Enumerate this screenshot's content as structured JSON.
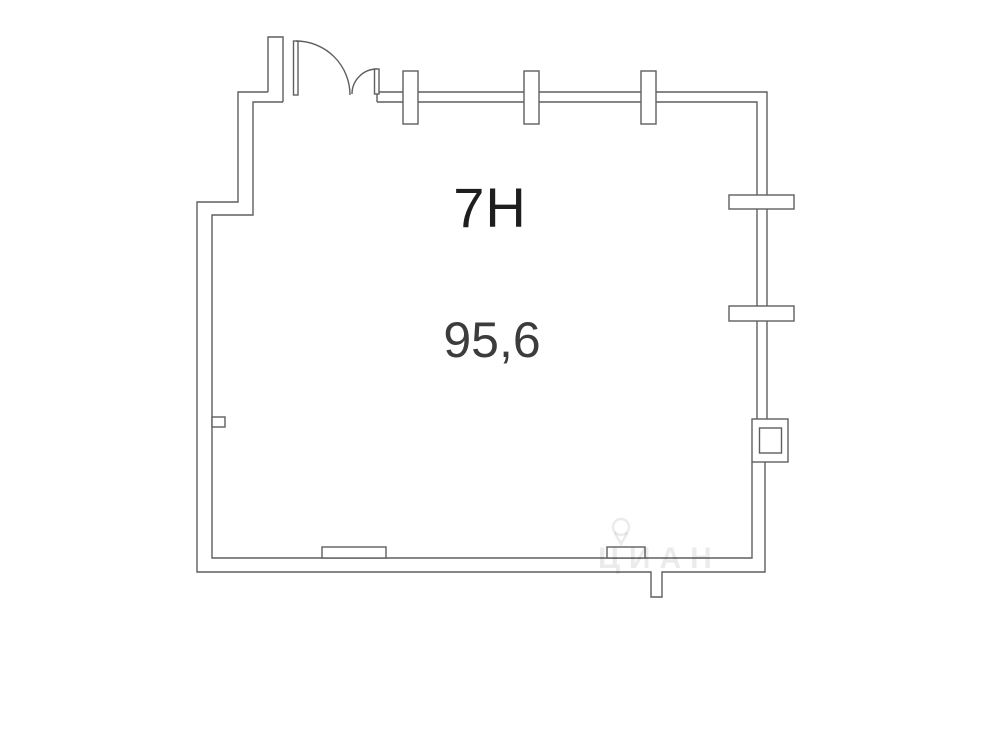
{
  "plan": {
    "unit_label": "7Н",
    "area_label": "95,6",
    "watermark": "ЦИАН",
    "colors": {
      "background": "#ffffff",
      "line": "#5f5f5f",
      "label": "#1e1e1e",
      "area": "#3c3c3c",
      "watermark_color": "rgba(0,0,0,0.08)"
    }
  }
}
